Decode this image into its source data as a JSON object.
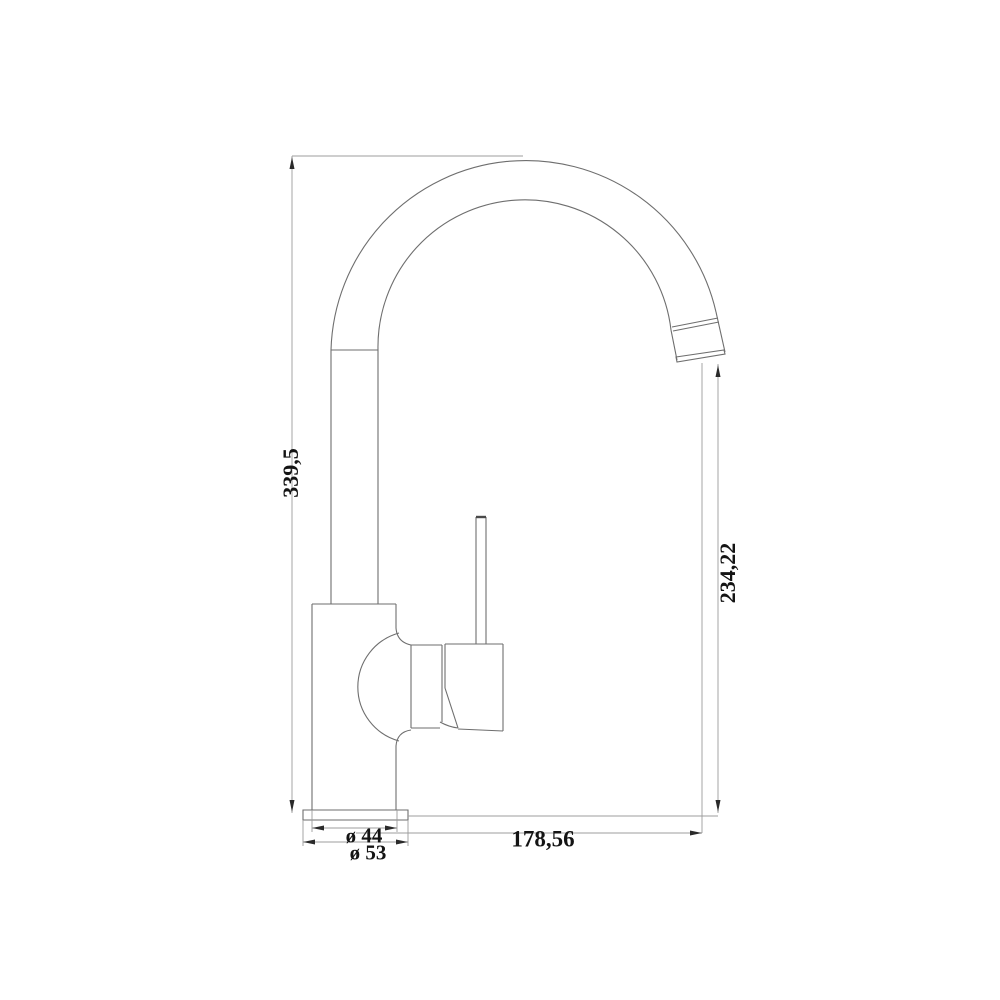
{
  "drawing": {
    "type": "technical-dimension-drawing",
    "subject": "kitchen-mixer-faucet-side-view",
    "colors": {
      "background": "#ffffff",
      "outline": "#6e6e6e",
      "dimension_line": "#9c9c9c",
      "text": "#141414",
      "arrow": "#2a2a2a"
    },
    "dimensions": {
      "overall_height": "339,5",
      "spout_outlet_height": "234,22",
      "spout_reach": "178,56",
      "body_diameter": "ø 44",
      "base_diameter": "ø 53"
    }
  }
}
